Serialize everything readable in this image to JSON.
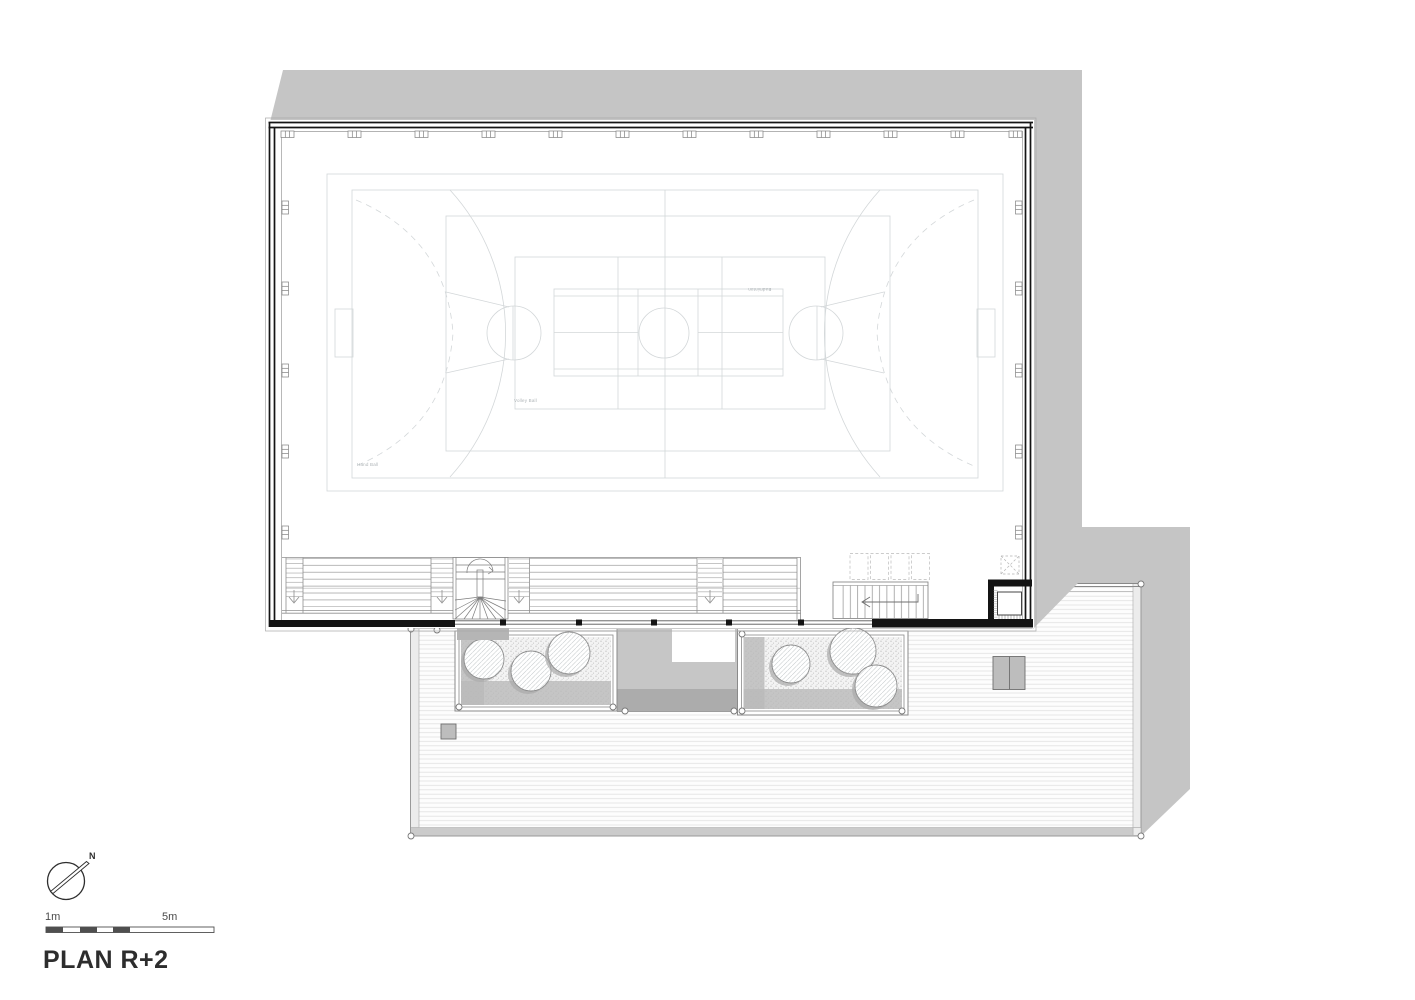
{
  "title": "PLAN R+2",
  "compass": {
    "north_label": "N"
  },
  "scale_bar": {
    "left_label": "1m",
    "right_label": "5m"
  },
  "court_labels": {
    "volleyball": "Volley Ball",
    "handball": "Hand Ball",
    "badminton": "Badminton"
  },
  "colors": {
    "shadow": "#c5c5c5",
    "wall_black": "#141414",
    "court_line": "#d3d7d9",
    "detail_line": "#8f8f8f",
    "deck_line": "#e0e0e0",
    "planter_bed": "#f3f3f3",
    "planter_shadow": "#b9b9b9",
    "void_fill": "#c6c6c6",
    "dark_band": "#acacac",
    "title_text": "#2d2d2d",
    "court_label_text": "#aeb4b7"
  }
}
